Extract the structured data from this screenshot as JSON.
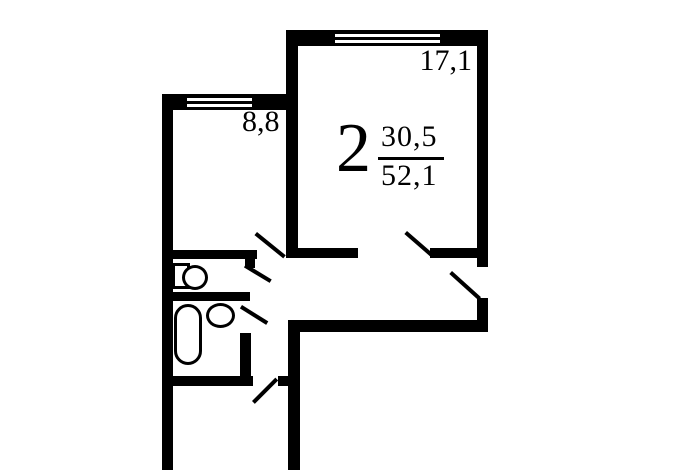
{
  "floorplan": {
    "apartment": {
      "rooms_count": "2",
      "living_area": "30,5",
      "total_area": "52,1"
    },
    "rooms": [
      {
        "name": "living-room",
        "area_label": "17,1"
      },
      {
        "name": "small-room",
        "area_label": "8,8"
      }
    ]
  },
  "colors": {
    "wall": "#000000",
    "background": "#ffffff"
  },
  "icons": {
    "toilet": "toilet-icon",
    "bathtub": "bathtub-icon",
    "sink": "sink-icon",
    "window": "window-icon",
    "door": "door-leaf-icon"
  }
}
